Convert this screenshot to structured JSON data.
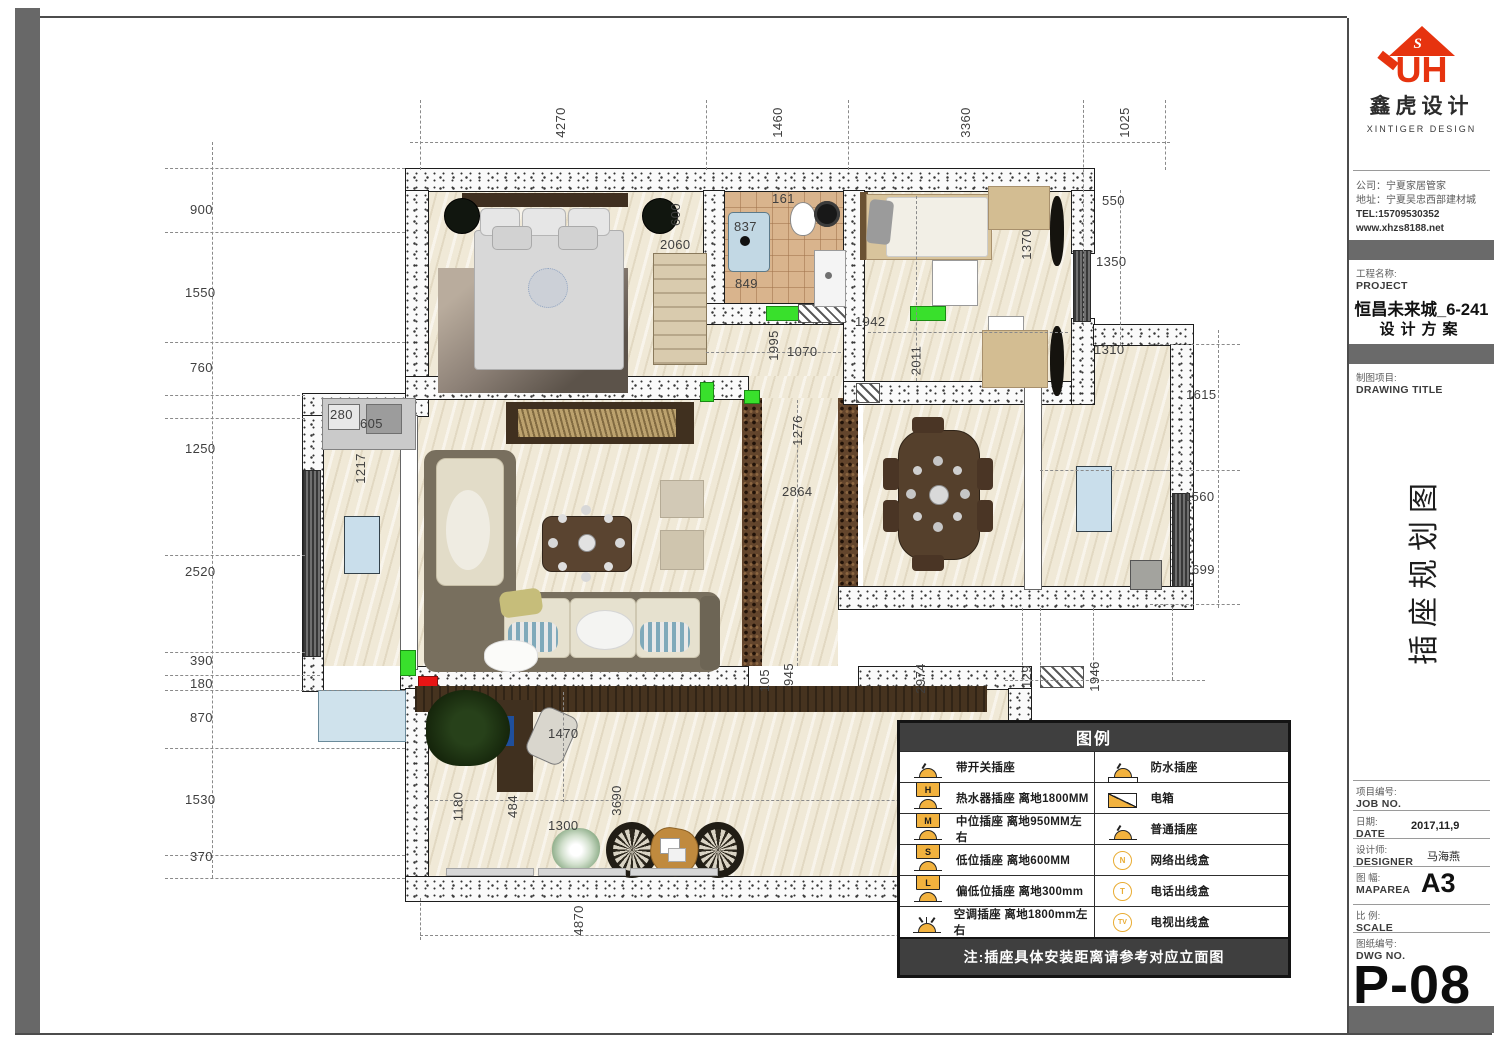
{
  "titleblock": {
    "brand": {
      "logo_s": "S",
      "logo_letters": "UH",
      "name_cn": "鑫虎设计",
      "name_en": "XINTIGER  DESIGN"
    },
    "company": {
      "line1": "公司：宁夏家居管家",
      "line2": "地址：宁夏吴忠西部建材城",
      "line3": "TEL:15709530352",
      "line4": "www.xhzs8188.net"
    },
    "project_label_cn": "工程名称:",
    "project_label_en": "PROJECT",
    "project_name": "恒昌未来城_6-241",
    "project_sub": "设计方案",
    "drawing_label_cn": "制图项目:",
    "drawing_label_en": "DRAWING TITLE",
    "drawing_title_vertical": "插座规划图",
    "job_cn": "项目编号:",
    "job_en": "JOB NO.",
    "date_cn": "日期:",
    "date_en": "DATE",
    "date_value": "2017,11,9",
    "designer_cn": "设计师:",
    "designer_en": "DESIGNER",
    "designer_value": "马海燕",
    "maparea_cn": "图 幅:",
    "maparea_en": "MAPAREA",
    "maparea_value": "A3",
    "scale_cn": "比 例:",
    "scale_en": "SCALE",
    "dwg_cn": "图纸编号:",
    "dwg_en": "DWG NO.",
    "dwg_value": "P-08"
  },
  "legend": {
    "title": "图例",
    "left": [
      {
        "icon": "switched-socket-icon",
        "letter": "",
        "label": "带开关插座"
      },
      {
        "icon": "water-heater-socket-icon",
        "letter": "H",
        "label": "热水器插座 离地1800MM"
      },
      {
        "icon": "mid-level-socket-icon",
        "letter": "M",
        "label": "中位插座 离地950MM左右"
      },
      {
        "icon": "low-level-socket-icon",
        "letter": "S",
        "label": "低位插座 离地600MM"
      },
      {
        "icon": "lower-level-socket-icon",
        "letter": "L",
        "label": "偏低位插座 离地300mm"
      },
      {
        "icon": "ac-socket-icon",
        "letter": "",
        "label": "空调插座 离地1800mm左右"
      }
    ],
    "right": [
      {
        "icon": "waterproof-socket-icon",
        "letter": "",
        "label": "防水插座"
      },
      {
        "icon": "distribution-box-icon",
        "letter": "",
        "label": "电箱"
      },
      {
        "icon": "plain-socket-icon",
        "letter": "",
        "label": "普通插座"
      },
      {
        "icon": "network-outlet-icon",
        "letter": "N",
        "label": "网络出线盒"
      },
      {
        "icon": "phone-outlet-icon",
        "letter": "T",
        "label": "电话出线盒"
      },
      {
        "icon": "tv-outlet-icon",
        "letter": "TV",
        "label": "电视出线盒"
      }
    ],
    "note": "注:插座具体安装距离请参考对应立面图"
  },
  "dims": {
    "d4270": "4270",
    "d1460": "1460",
    "d3360": "3360",
    "d1025": "1025",
    "d900": "900",
    "d1550": "1550",
    "d760": "760",
    "d1250": "1250",
    "d2520": "2520",
    "d390": "390",
    "d180": "180",
    "d870": "870",
    "d1530": "1530",
    "d370": "370",
    "d550": "550",
    "d1350": "1350",
    "d1310": "1310",
    "d1615": "1615",
    "d1560": "1560",
    "d699": "699",
    "d161": "161",
    "d837": "837",
    "d849": "849",
    "d600": "600",
    "d2060": "2060",
    "d1370": "1370",
    "d1942": "1942",
    "d2011": "2011",
    "d1995": "1995",
    "d1070": "1070",
    "d1276": "1276",
    "d2864": "2864",
    "d280": "280",
    "d605": "605",
    "d1217": "1217",
    "d1470": "1470",
    "d1180": "1180",
    "d484": "484",
    "d1300": "1300",
    "d3690": "3690",
    "d105": "105",
    "d945": "945",
    "d2974": "2974",
    "d129": "129",
    "d1946": "1946",
    "d4870": "4870"
  },
  "colors": {
    "brand_red": "#e6330f",
    "legend_yellow": "#f2b23e",
    "bar_gray": "#6a6a6a"
  }
}
